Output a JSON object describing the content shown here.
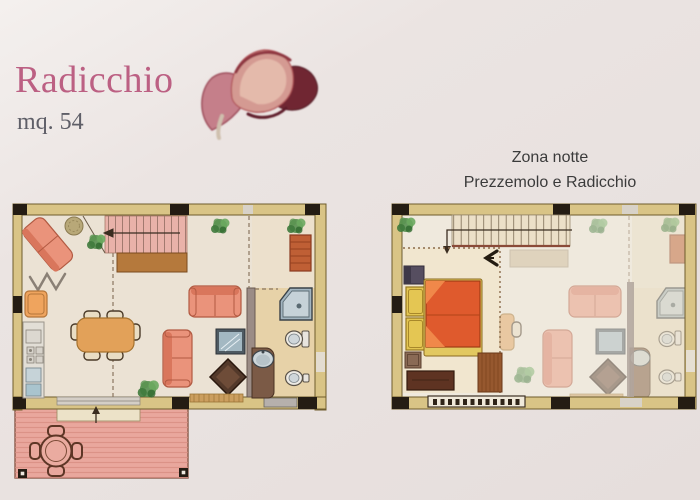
{
  "page": {
    "title": "Radicchio",
    "area_label": "mq. 54",
    "night_zone_title_line1": "Zona notte",
    "night_zone_title_line2": "Prezzemolo e Radicchio"
  },
  "plans": {
    "left_plan_name": "ground-floor-plan",
    "right_plan_name": "night-zone-plan"
  },
  "illustration": {
    "name": "radicchio-flower"
  },
  "colors": {
    "page_bg": "#e9e2e0",
    "title_pink": "#bc6083",
    "subtitle_gray": "#5f5f68",
    "plan_title_gray": "#3b3b3b",
    "wall_fill": "#d9c486",
    "wall_line": "#6e5c2c",
    "corner_black": "#241c13",
    "floor": "#ebe2d4",
    "floor_warm": "#e7d2a8",
    "terrace_pink": "#e9a79d",
    "terrace_hatch": "#d68b80",
    "stair_pink": "#e9b2a9",
    "landing_brown": "#b5793c",
    "sofa_salmon": "#ea937b",
    "sofa_dark": "#d9765c",
    "sofa_line": "#b25a42",
    "armchair_orange": "#efa45e",
    "table_orange": "#e2a159",
    "bed_orange": "#df5a2d",
    "wardrobe_yellow": "#e4c653",
    "dresser_brown": "#5e3322",
    "rug_brown": "#96582f",
    "rug_brick": "#bf5f35",
    "fixture_gray": "#a3b5c0",
    "fixture_light": "#c6d2d8",
    "counter_brown": "#7b5a46",
    "plant_green": "#4e8a48",
    "ink": "#3a2d20"
  }
}
